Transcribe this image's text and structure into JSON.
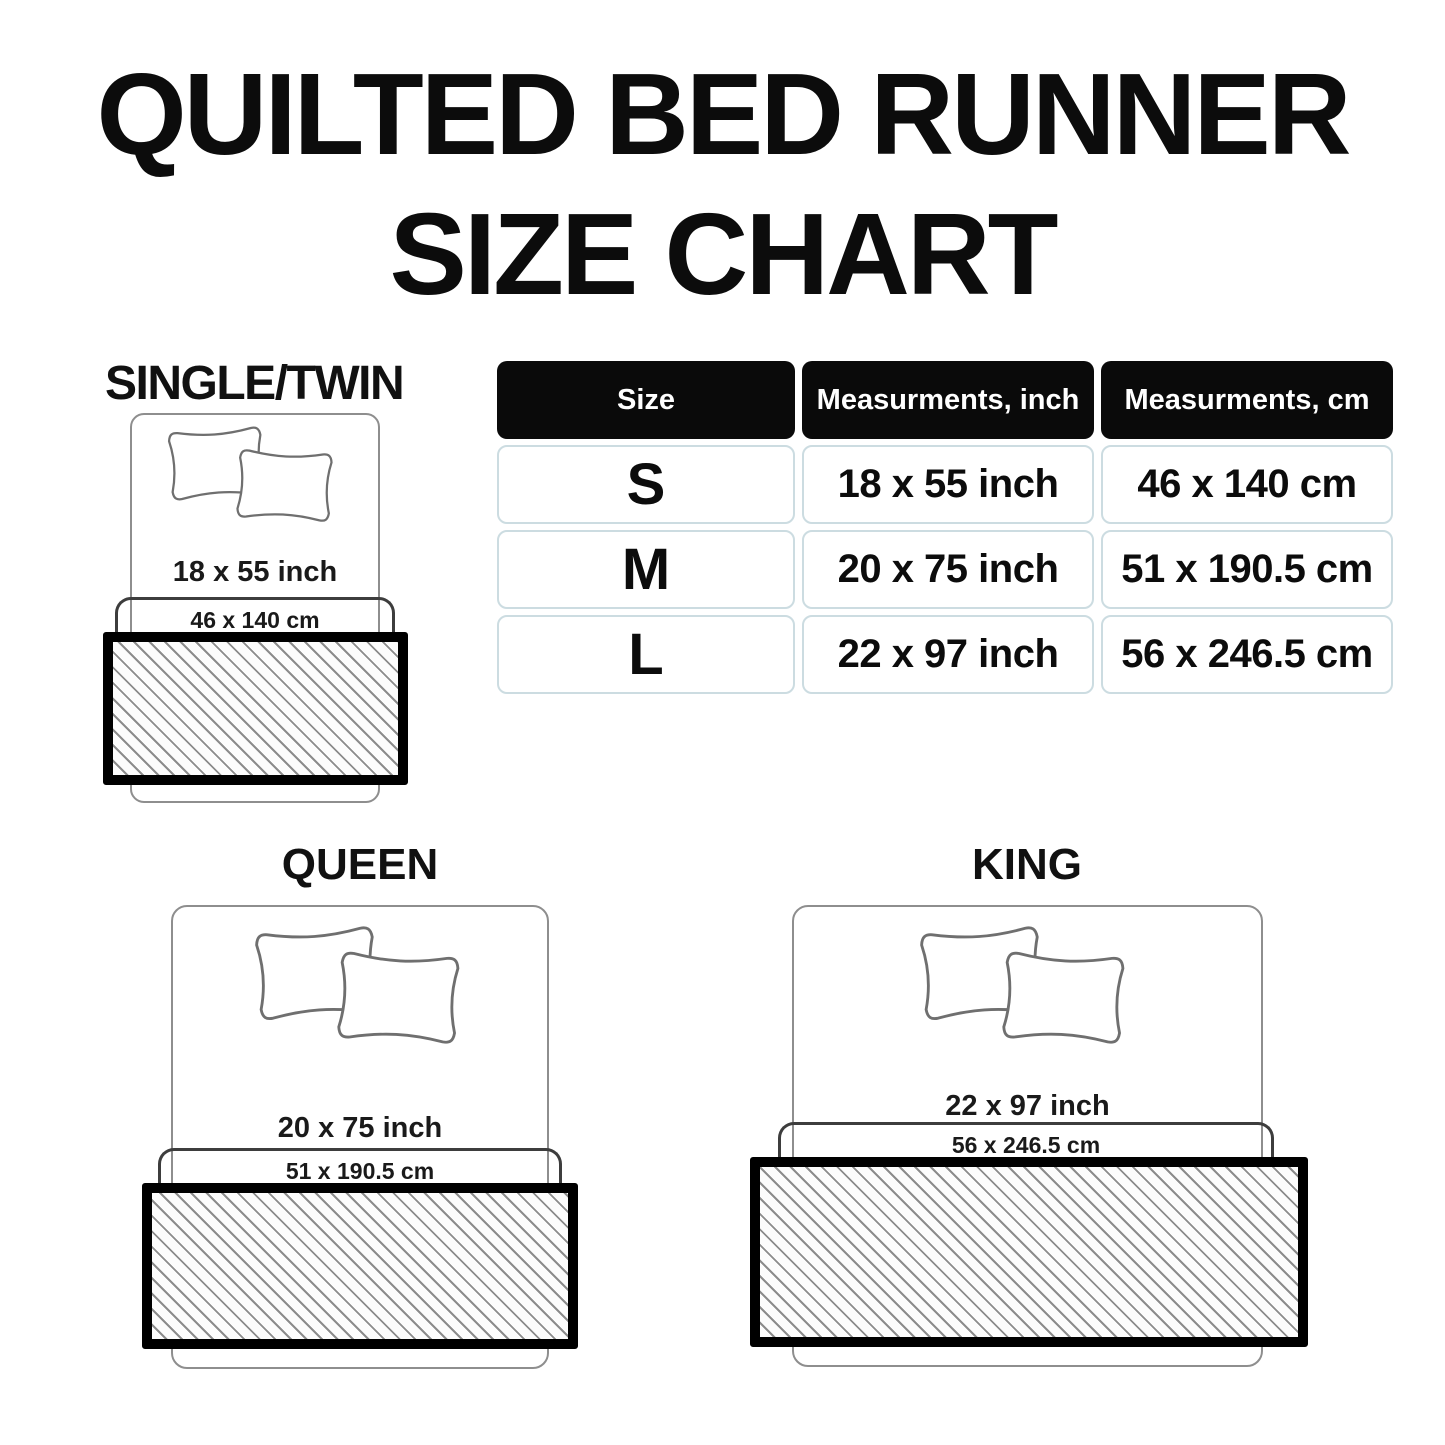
{
  "title": {
    "line1": "QUILTED BED RUNNER",
    "line2": "SIZE CHART"
  },
  "table": {
    "headers": {
      "size": "Size",
      "inch": "Measurments, inch",
      "cm": "Measurments, cm"
    },
    "rows": [
      {
        "size": "S",
        "inch": "18 x 55 inch",
        "cm": "46 x 140 cm"
      },
      {
        "size": "M",
        "inch": "20 x 75 inch",
        "cm": "51 x 190.5 cm"
      },
      {
        "size": "L",
        "inch": "22 x 97 inch",
        "cm": "56 x 246.5 cm"
      }
    ]
  },
  "diagrams": {
    "single": {
      "label": "SINGLE/TWIN",
      "inch": "18 x 55 inch",
      "cm": "46 x 140 cm"
    },
    "queen": {
      "label": "QUEEN",
      "inch": "20 x 75 inch",
      "cm": "51 x 190.5 cm"
    },
    "king": {
      "label": "KING",
      "inch": "22 x 97 inch",
      "cm": "56 x 246.5 cm"
    }
  },
  "colors": {
    "header_bg": "#0a0a0a",
    "cell_border": "#ccdce1",
    "outline_gray": "#8e8e8e",
    "hatch_line": "#8c8c8c",
    "runner_border": "#000000"
  }
}
